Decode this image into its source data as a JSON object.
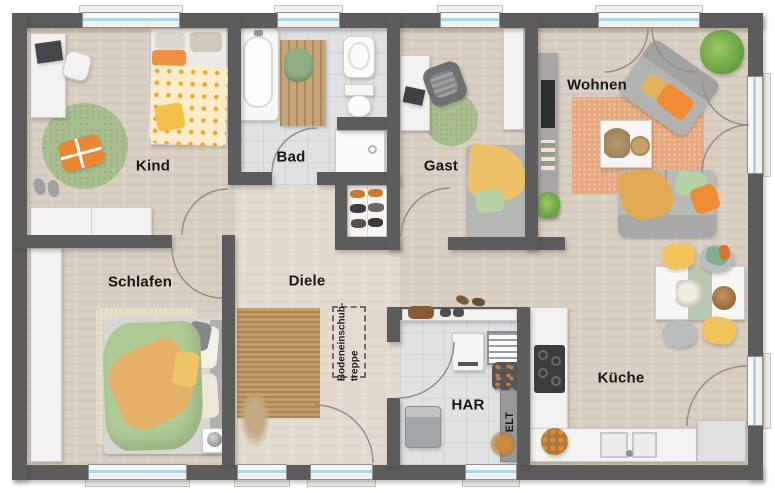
{
  "floor_plan": {
    "rooms": {
      "kind": {
        "label": "Kind"
      },
      "bad": {
        "label": "Bad"
      },
      "gast": {
        "label": "Gast"
      },
      "wohnen": {
        "label": "Wohnen"
      },
      "schlafen": {
        "label": "Schlafen"
      },
      "diele": {
        "label": "Diele"
      },
      "har": {
        "label": "HAR"
      },
      "kueche": {
        "label": "Küche"
      },
      "elt": {
        "label": "ELT"
      }
    },
    "annotations": {
      "attic_stairs": {
        "line1": "Bodeneinschub-",
        "line2": "treppe"
      }
    },
    "palette": {
      "wall": "#5c5c5c",
      "wood_floor": "#d9cfc3",
      "tile_floor": "#dfe1e3",
      "window_glass": "#a9d7ea",
      "rug_green": "#a9bf90",
      "rug_terracotta": "#e8a87d",
      "rug_jute": "#c49e68",
      "accent_orange": "#ee8a33",
      "accent_yellow": "#f2c45e",
      "accent_green_pillow": "#b7d2a5",
      "sofa_gray": "#b3b3b1"
    }
  }
}
